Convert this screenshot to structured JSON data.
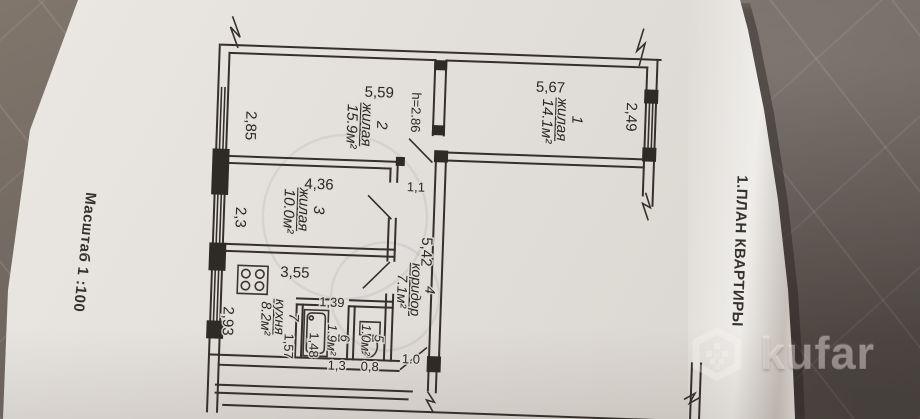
{
  "photo": {
    "watermark_text": "kufar"
  },
  "margin_labels": {
    "scale": "Масштаб 1 :100",
    "title": "1.ПЛАН КВАРТИРЫ"
  },
  "plan": {
    "rooms": [
      {
        "number": "1",
        "name": "жилая",
        "area": "14.1м²"
      },
      {
        "number": "2",
        "name": "жилая",
        "area": "15.9м²"
      },
      {
        "number": "3",
        "name": "жилая",
        "area": "10.0м²"
      },
      {
        "number": "4",
        "name": "коридор",
        "area": "7.1м²"
      },
      {
        "number": "5",
        "area": "1.0м²"
      },
      {
        "number": "6",
        "area": "1.9м²"
      },
      {
        "number": "7",
        "name": "кухня",
        "area": "8.2м²"
      }
    ],
    "dimensions": {
      "room1_width": "5,67",
      "room1_depth": "2,49",
      "room2_width": "5,59",
      "room2_depth": "2,85",
      "ceiling_height": "h=2.86",
      "room3_width": "4,36",
      "room3_depth": "2,3",
      "corridor_length": "5,42",
      "corridor_width": "1,1",
      "entrance_width": "1.0",
      "kitchen_width": "3,55",
      "kitchen_depth": "2,93",
      "bath_width": "1,39",
      "bath_depth": "1,57",
      "tub_length": "1,48",
      "bath_bottom_width": "1,3",
      "wc_width": "0,8"
    }
  }
}
